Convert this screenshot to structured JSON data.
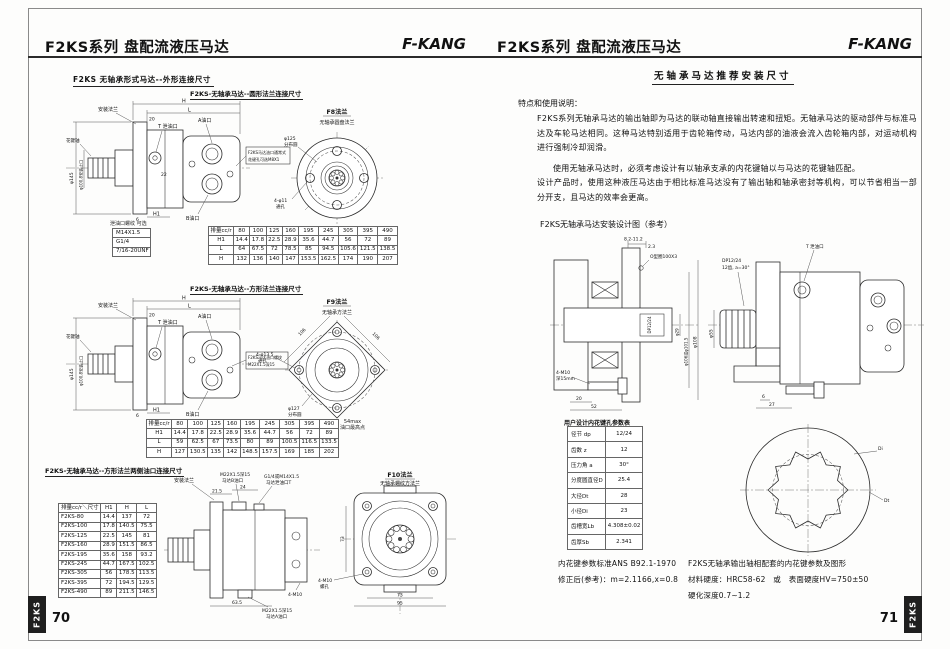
{
  "colors": {
    "line": "#2b2b2b",
    "tab_bg": "#1f1f1f",
    "tab_text": "#ffffff",
    "paper": "#fdfdfc"
  },
  "left": {
    "header": {
      "title": "F2KS系列 盘配流液压马达",
      "brand": "F-KANG"
    },
    "page_number": "70",
    "side_tab": "F2KS",
    "section_title": "F2KS 无轴承形式马达--外形连接尺寸",
    "round": {
      "subtitle": "F2KS-无轴承马达--圆形法兰连接尺寸",
      "flange_name": "F8法兰",
      "flange_desc": "无轴承圆盘法兰",
      "callouts": {
        "spline_shaft": "花键轴",
        "mount_flange": "安装法兰",
        "drain_port": "T 泄油口",
        "port_a": "A油口",
        "port_b": "B油口",
        "note_line1": "F2KS马达油口通常式",
        "note_line2": "花键孔可选M8X1",
        "dia_outer": "φ145",
        "dia_spigot": "φ100.8安装止口",
        "bolt_circle_dia": "φ125",
        "bolt_circle_txt": "分布圆",
        "bolt_holes_dia": "4-φ11",
        "bolt_holes_txt": "通孔",
        "dim_h": "H",
        "dim_l": "L",
        "dim_h1": "H1",
        "dim_20": "20",
        "dim_22": "22",
        "dim_6": "6"
      },
      "thread_table_title": "泄油口螺纹 可选",
      "thread_table": [
        [
          "M14X1.5"
        ],
        [
          "G1/4"
        ],
        [
          "7/16-20UNF"
        ]
      ],
      "dim_table": [
        [
          "排量cc/r",
          "80",
          "100",
          "125",
          "160",
          "195",
          "245",
          "305",
          "395",
          "490"
        ],
        [
          "H1",
          "14.4",
          "17.8",
          "22.5",
          "28.9",
          "35.6",
          "44.7",
          "56",
          "72",
          "89"
        ],
        [
          "L",
          "64",
          "67.5",
          "72",
          "78.5",
          "85",
          "94.5",
          "105.6",
          "121.5",
          "138.5"
        ],
        [
          "H",
          "132",
          "136",
          "140",
          "147",
          "153.5",
          "162.5",
          "174",
          "190",
          "207"
        ]
      ]
    },
    "square": {
      "subtitle": "F2KS-无轴承马达--方形法兰连接尺寸",
      "flange_name": "F9法兰",
      "flange_desc": "无轴承方法兰",
      "callouts": {
        "spline_shaft": "花键轴",
        "mount_flange": "安装法兰",
        "drain_port": "T 泄油口",
        "port_a": "A油口",
        "port_b": "B油口",
        "note_line1": "F2KS马达油口螺纹",
        "note_line2": "M22X1.5深15",
        "dia_outer": "φ145",
        "dia_spigot": "φ100.8安装止口",
        "bolt_circle_dia": "φ127",
        "bolt_circle_txt": "分布圆",
        "bolt_holes_dia": "4-φ13.5",
        "bolt_holes_txt": "通孔",
        "edge_dim_l": "106",
        "edge_dim_r": "106",
        "dim_h": "H",
        "dim_l": "L",
        "dim_h1": "H1",
        "dim_20": "20",
        "dim_6": "6"
      },
      "dim_table": [
        [
          "排量cc/r",
          "80",
          "100",
          "125",
          "160",
          "195",
          "245",
          "305",
          "395",
          "490"
        ],
        [
          "H1",
          "14.4",
          "17.8",
          "22.5",
          "28.9",
          "35.6",
          "44.7",
          "56",
          "72",
          "89"
        ],
        [
          "L",
          "59",
          "62.5",
          "67",
          "73.5",
          "80",
          "89",
          "100.5",
          "116.5",
          "133.5"
        ],
        [
          "H",
          "127",
          "130.5",
          "135",
          "142",
          "148.5",
          "157.5",
          "169",
          "185",
          "202"
        ]
      ],
      "note_54_line1": "54max",
      "note_54_line2": "油口最高点"
    },
    "dual_port": {
      "subtitle": "F2KS-无轴承马达--方形法兰两侧油口连接尺寸",
      "flange_name": "F10法兰",
      "flange_desc": "无轴承螺纹方法兰",
      "callouts": {
        "mount_flange": "安装法兰",
        "port_b_line1": "M22X1.5深15",
        "port_b_line2": "马达B油口",
        "drain_line1": "G1/4或M14X1.5",
        "drain_line2": "马达泄油口T",
        "dim_215": "21.5",
        "dim_24": "24",
        "dim_635": "63.5",
        "bolt_note": "4-M10",
        "port_a_line1": "M22X1.5深15",
        "port_a_line2": "马达A油口",
        "bolt_holes_line1": "4-M10",
        "bolt_holes_line2": "螺孔",
        "dim_73v": "73",
        "dim_73h": "73",
        "dim_95": "95"
      },
      "dim_table": [
        [
          "排量cc/r＼尺寸",
          "H1",
          "H",
          "L"
        ],
        [
          "F2KS-80",
          "14.4",
          "137",
          "72"
        ],
        [
          "F2KS-100",
          "17.8",
          "140.5",
          "75.5"
        ],
        [
          "F2KS-125",
          "22.5",
          "145",
          "81"
        ],
        [
          "F2KS-160",
          "28.9",
          "151.5",
          "86.5"
        ],
        [
          "F2KS-195",
          "35.6",
          "158",
          "93.2"
        ],
        [
          "F2KS-245",
          "44.7",
          "167.5",
          "102.5"
        ],
        [
          "F2KS-305",
          "56",
          "178.5",
          "113.5"
        ],
        [
          "F2KS-395",
          "72",
          "194.5",
          "129.5"
        ],
        [
          "F2KS-490",
          "89",
          "211.5",
          "146.5"
        ]
      ]
    }
  },
  "right": {
    "header": {
      "title": "F2KS系列 盘配流液压马达",
      "brand": "F-KANG"
    },
    "page_number": "71",
    "side_tab": "F2KS",
    "section_title": "无轴承马达推荐安装尺寸",
    "intro_heading": "特点和使用说明：",
    "intro_p1": "F2KS系列无轴承马达的输出轴即为马达的联动轴直接输出转速和扭矩。无轴承马达的驱动部件与标准马达及车轮马达相同。这种马达特别适用于齿轮箱传动，马达内部的油液会流入齿轮箱内部，对运动机构进行强制冷却润滑。",
    "intro_p2": "使用无轴承马达时，必须考虑设计有以轴承支承的内花键轴以与马达的花键轴匹配。",
    "intro_p3": "设计产品时，使用这种液压马达由于相比标准马达没有了输出轴和轴承密封等机构，可以节省相当一部分开支，且马达的效率会更高。",
    "diagram_title": "F2KS无轴承马达安装设计图（参考）",
    "install": {
      "callouts": {
        "dim_top": "8.2-11.2",
        "dim_23": "2.3",
        "oring": "O型圈100X3",
        "spline_mark": "DP12/24",
        "dia_29": "φ29",
        "dia_106": "φ106或φ101.5",
        "dia_108": "φ108",
        "bolts_line1": "4-M10",
        "bolts_line2": "深15mm",
        "dim_20": "20",
        "dim_52": "52",
        "spline_line1": "DP12/24",
        "spline_line2": "12齿, a=30°",
        "drain": "T 泄油口",
        "dia_55": "φ55",
        "dim_6": "6",
        "dim_27": "27"
      }
    },
    "spline_table_title": "用户设计内花键孔参数表",
    "spline_table": [
      [
        "径节 dp",
        "12/24"
      ],
      [
        "齿数 z",
        "12"
      ],
      [
        "压力角 a",
        "30°"
      ],
      [
        "分度圆直径D",
        "25.4"
      ],
      [
        "大径Dt",
        "28"
      ],
      [
        "小径Di",
        "23"
      ],
      [
        "齿槽宽Lb",
        "4.308±0.02"
      ],
      [
        "齿厚Sb",
        "2.341"
      ]
    ],
    "spline_profile": {
      "label_di": "Di",
      "label_dt": "Dt"
    },
    "std_note_line1": "内花键参数标准ANS B92.1-1970",
    "std_note_line2": "修正后(参考)：m=2.1166,x=0.8",
    "match_note_line1": "F2KS无轴承输出轴相配套的内花键参数及图形",
    "match_note_line2": "材料硬度：HRC58-62　或　表面硬度HV=750±50",
    "match_note_line3": "硬化深度0.7~1.2"
  }
}
